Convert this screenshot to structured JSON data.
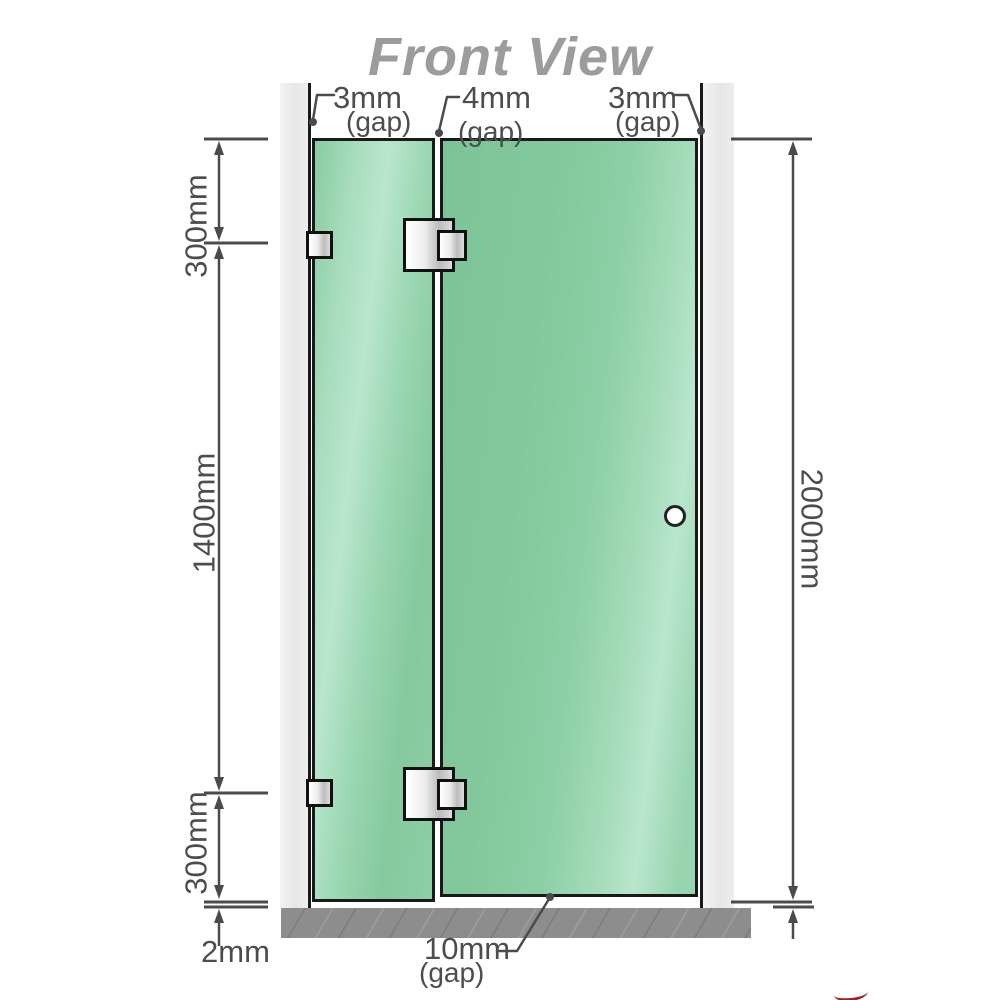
{
  "title": "Front View",
  "gaps": {
    "top_left": {
      "value": "3mm",
      "label": "(gap)"
    },
    "top_middle": {
      "value": "4mm",
      "label": "(gap)"
    },
    "top_right": {
      "value": "3mm",
      "label": "(gap)"
    },
    "bottom_door": {
      "value": "10mm",
      "label": "(gap)"
    },
    "floor_clearance": {
      "value": "2mm"
    }
  },
  "dimensions": {
    "top_section": "300mm",
    "middle_section": "1400mm",
    "bottom_section": "300mm",
    "total_height": "2000mm"
  },
  "colors": {
    "glass-green": "#8ccfa6",
    "glass-highlight": "#b9e6cd",
    "outline-black": "#1a1a1a",
    "wall-gray": "#ebebeb",
    "floor-gray": "#8d8d8d",
    "dim-gray": "#4b4b4b",
    "label-gray": "#4d4d4d",
    "title-gray": "#9c9c9c",
    "metal-light": "#ffffff",
    "metal-dark": "#bcbcbc",
    "logo-red": "#a31c26"
  }
}
